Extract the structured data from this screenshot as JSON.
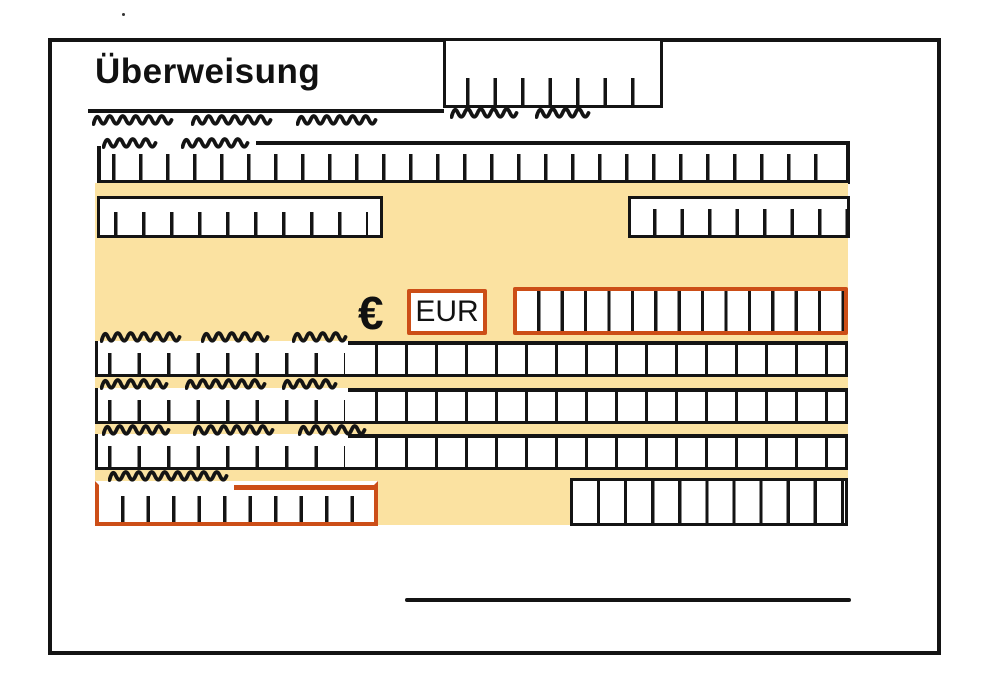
{
  "form": {
    "title": "Überweisung",
    "currency": {
      "symbol": "€",
      "code": "EUR"
    }
  },
  "colors": {
    "highlight": "#FBE2A1",
    "accent": "#CC4E17",
    "ink": "#141414",
    "paper": "#FFFFFF"
  }
}
